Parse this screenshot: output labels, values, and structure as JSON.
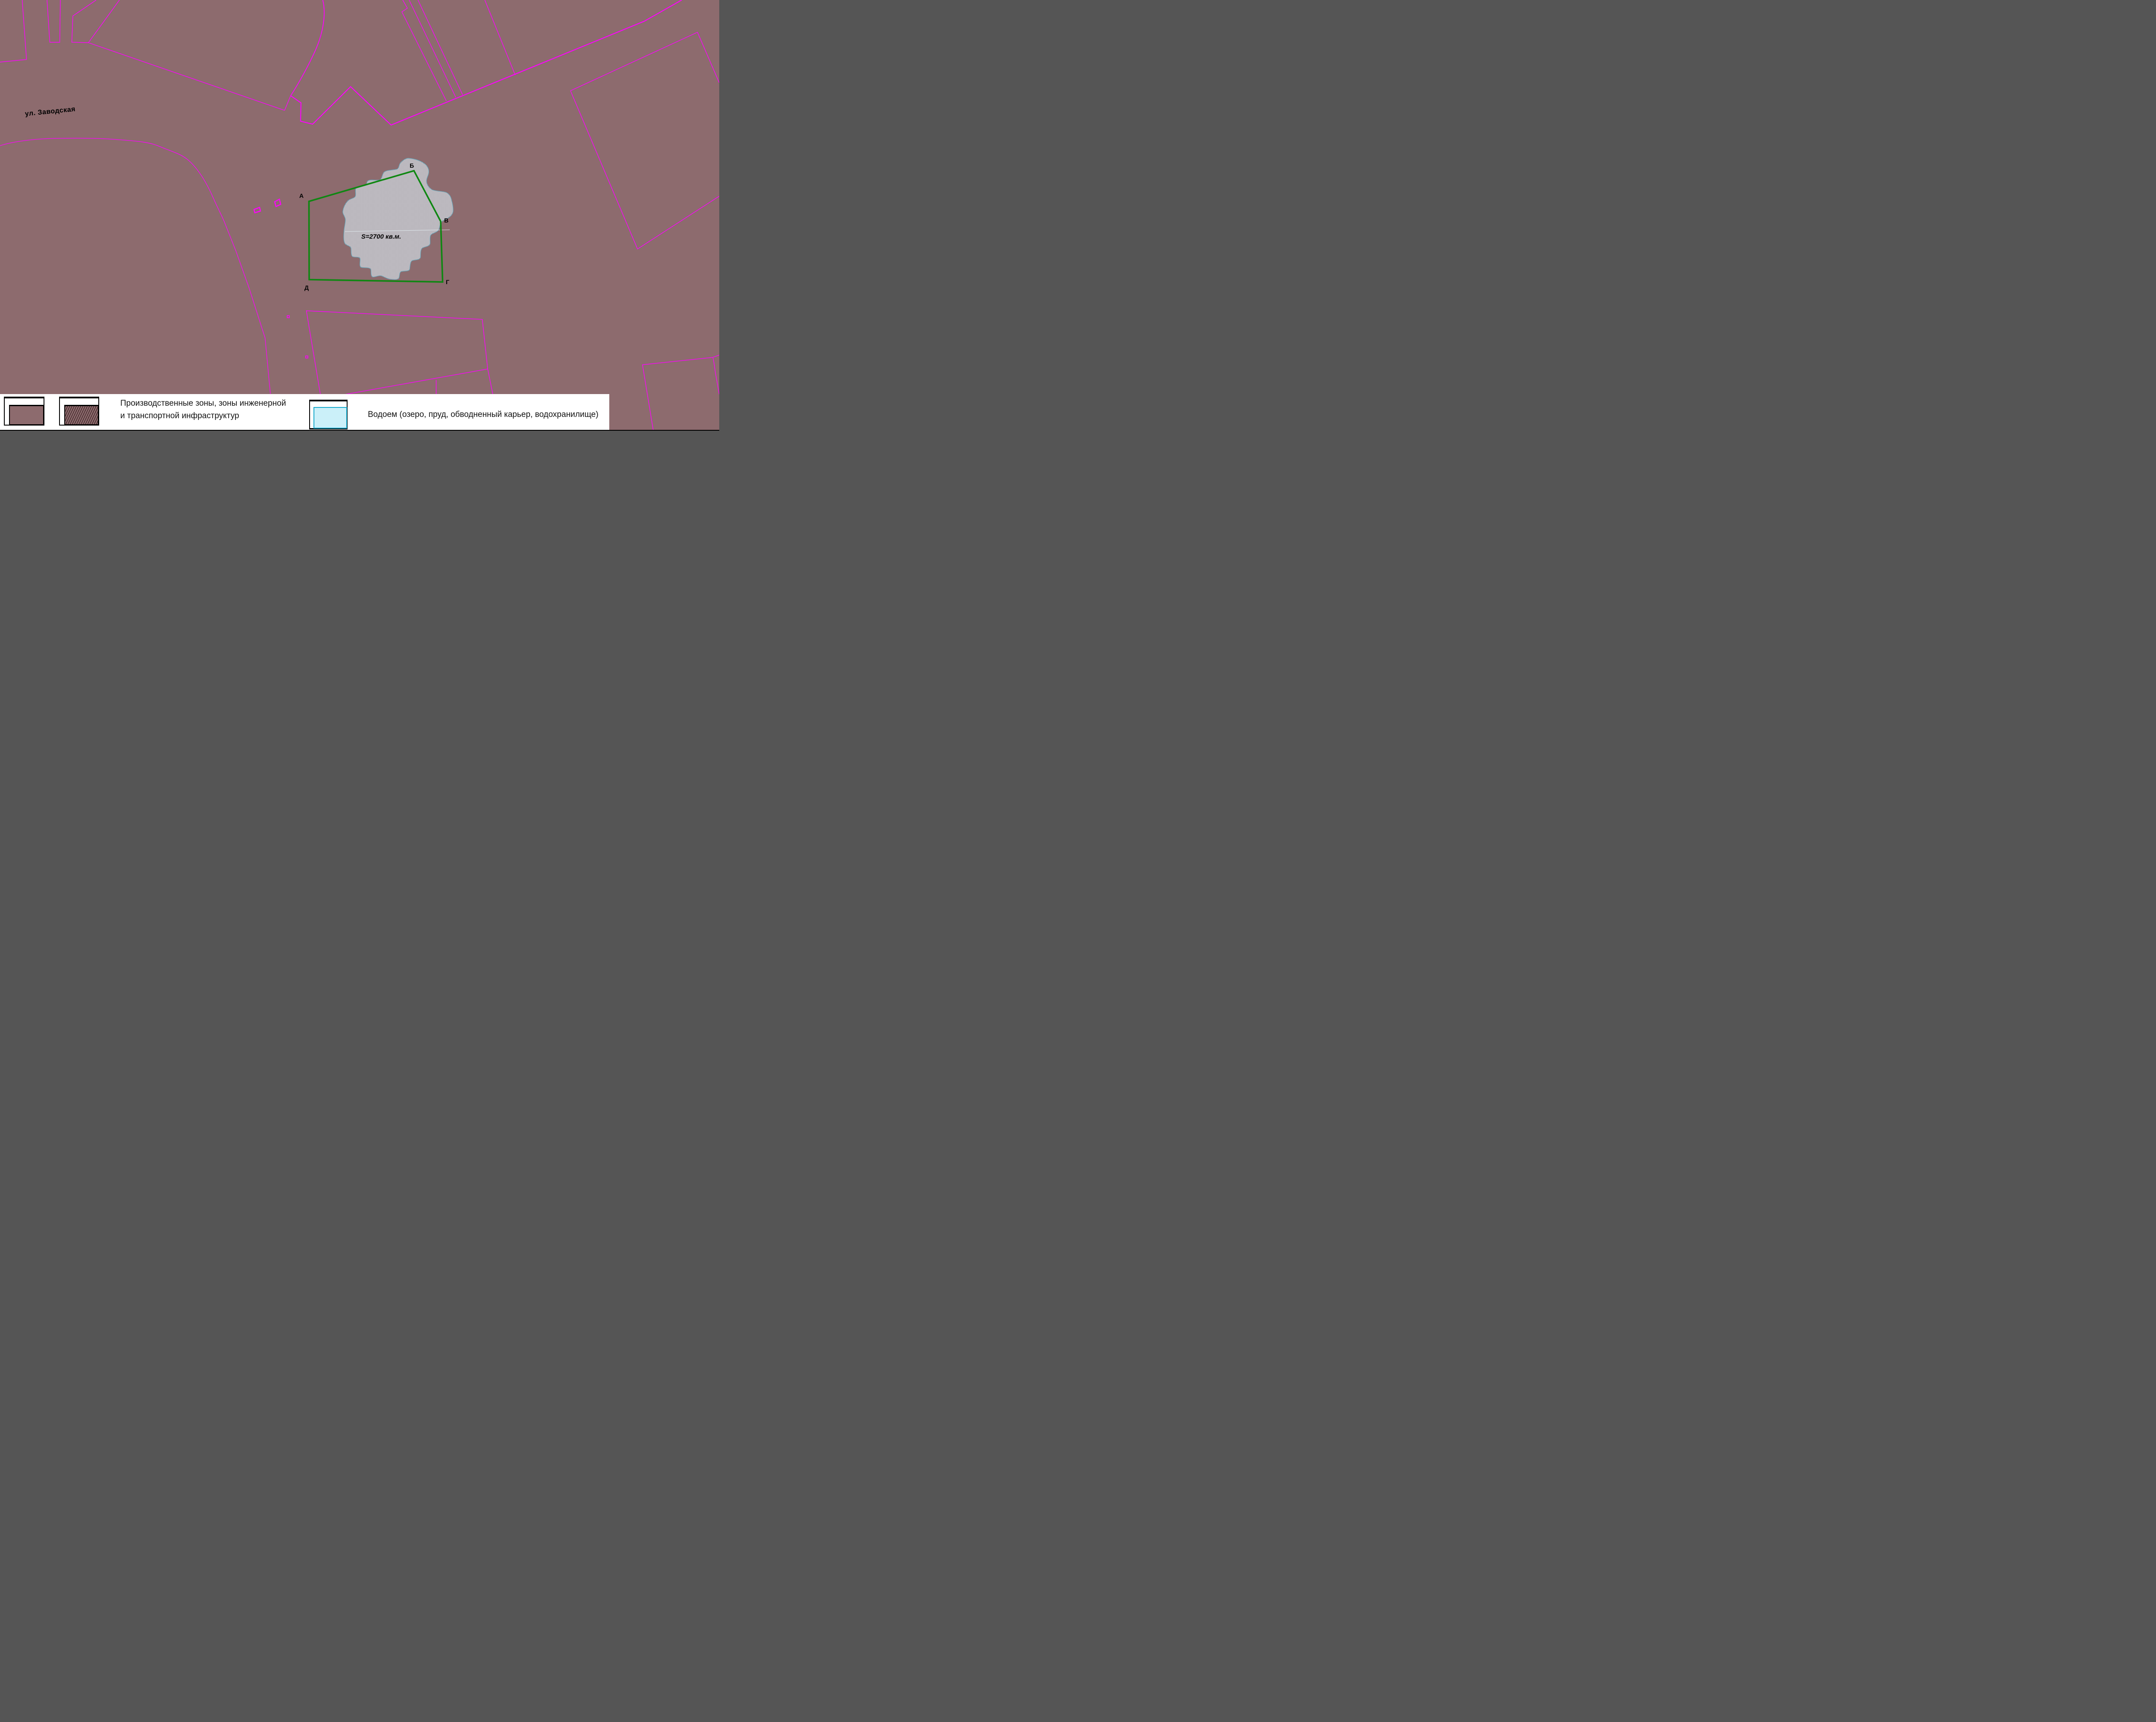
{
  "map": {
    "street_label": "ул. Заводская",
    "area_label": "S=2700 кв.м.",
    "vertices": [
      "А",
      "Б",
      "В",
      "Г",
      "Д"
    ],
    "colors": {
      "background": "#8D6B6E",
      "parcel_line": "#FF00FF",
      "site_boundary_green": "#0F8712",
      "water_dither_light": "#DCF2FA",
      "water_dither_dark": "#9B7F83",
      "water_outline": "#67A3B6",
      "label_text": "#000000"
    }
  },
  "legend": {
    "items": [
      {
        "id": "production-zones",
        "label_line1": "Производственные зоны, зоны инженерной",
        "label_line2": "и транспортной инфраструктур",
        "swatches": [
          "solid-zone-fill",
          "hatched-zone-fill"
        ],
        "swatch_color": "#8D6B6E",
        "hatch_color": "#3A2123"
      },
      {
        "id": "water-body",
        "label": "Водоем (озеро, пруд, обводненный карьер, водохранилище)",
        "swatch": "water-fill",
        "swatch_color": "#CBF0F9",
        "swatch_border": "#17A9CC"
      }
    ],
    "background": "#FFFFFF"
  }
}
